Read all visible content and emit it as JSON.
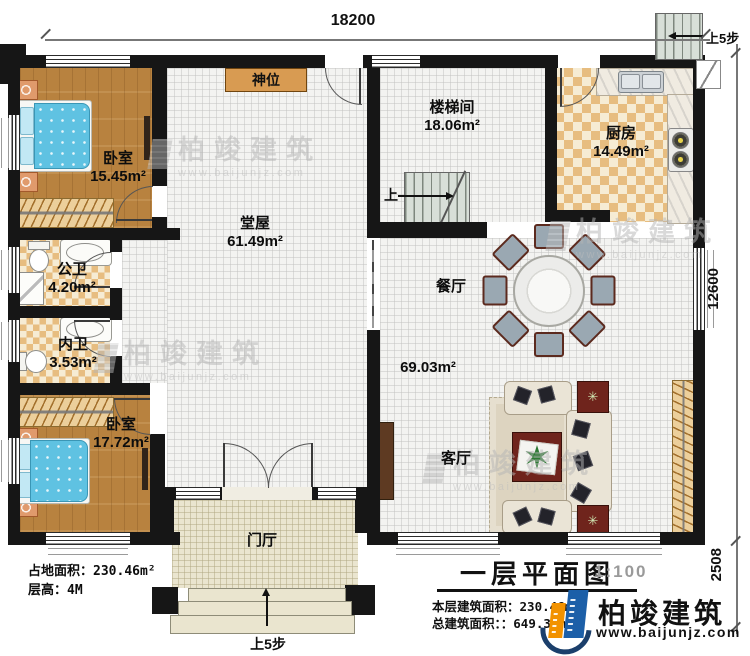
{
  "dimensions": {
    "top": "18200",
    "right": "12600",
    "right_lower": "2508"
  },
  "rooms": {
    "bedroom1": {
      "name": "卧室",
      "area": "15.45m²"
    },
    "public_bath": {
      "name": "公卫",
      "area": "4.20m²"
    },
    "inner_bath": {
      "name": "内卫",
      "area": "3.53m²"
    },
    "bedroom2": {
      "name": "卧室",
      "area": "17.72m²"
    },
    "hall": {
      "name": "堂屋",
      "area": "61.49m²"
    },
    "stairwell": {
      "name": "楼梯间",
      "area": "18.06m²"
    },
    "kitchen": {
      "name": "厨房",
      "area": "14.49m²"
    },
    "dining": {
      "name": "餐厅"
    },
    "living": {
      "name": "客厅"
    },
    "foyer": {
      "name": "门厅"
    },
    "open_area": {
      "area": "69.03m²"
    }
  },
  "annotations": {
    "shrine": "神位",
    "stair_up": "上",
    "steps_up_right": "上5步",
    "steps_up_front": "上5步"
  },
  "site_info": {
    "area_label": "占地面积：",
    "area_value": "230.46m²",
    "height_label": "层高：",
    "height_value": "4M"
  },
  "title_block": {
    "title": "一层平面图",
    "scale": "1:100",
    "floor_area_label": "本层建筑面积：",
    "floor_area_value": "230.46m²",
    "total_area_label": "总建筑面积：：",
    "total_area_value": "649.33m²"
  },
  "brand": {
    "name": "柏竣建筑",
    "website": "www.baijunjz.com"
  },
  "watermark": {
    "name": "柏竣建筑",
    "website": "www.baijunjz.com"
  },
  "icons": {
    "side_table_star": "✳"
  },
  "colors": {
    "wall": "#161616",
    "wood": "#b8823f",
    "tile": "#e7bd80",
    "shrine": "#d89b52",
    "bed": "#5fc2e2",
    "brand_blue": "#1c5fa8",
    "brand_orange": "#f29200"
  }
}
